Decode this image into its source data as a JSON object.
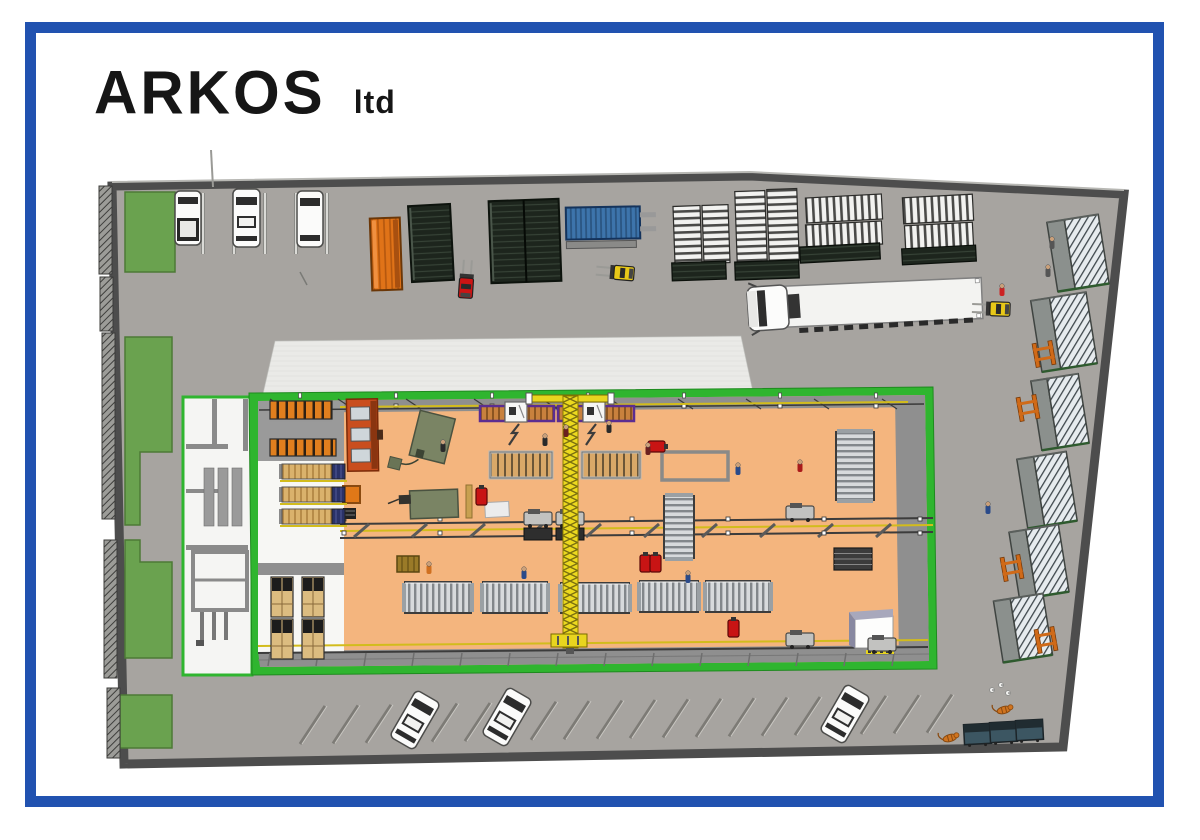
{
  "title": {
    "company": "ARKOS",
    "suffix": "ltd"
  },
  "palette": {
    "frame_blue": "#2152b0",
    "ground": "#a7a4a0",
    "wall": "#4d4d4d",
    "grass": "#6aa24f",
    "building_green": "#2fb52f",
    "floor_orange": "#f4b57e",
    "canopy": "#eaeae7",
    "container_orange": "#e07318",
    "container_dark": "#1d251d",
    "container_blue": "#3d74ab",
    "crane_yellow": "#e8d51f",
    "annex_white": "#f5f5f3"
  },
  "scene": {
    "grass": [
      {
        "pts": "125,192 175,192 175,272 125,272"
      },
      {
        "pts": "125,337 172,337 172,452 140,452 140,525 125,525"
      },
      {
        "pts": "125,540 140,540 140,562 172,562 172,658 125,658"
      },
      {
        "pts": "120,695 172,695 172,748 120,748"
      }
    ],
    "fence": [
      {
        "x": 99,
        "y": 186,
        "h": 88
      },
      {
        "x": 100,
        "y": 277,
        "h": 54
      },
      {
        "x": 102,
        "y": 333,
        "h": 186
      },
      {
        "x": 104,
        "y": 540,
        "h": 138
      },
      {
        "x": 107,
        "y": 688,
        "h": 70
      }
    ],
    "top_parking": {
      "dividers": [
        203,
        234,
        265,
        296,
        327
      ],
      "div_y1": 193,
      "div_y2": 254,
      "cars": [
        {
          "x": 175,
          "y": 191,
          "w": 26,
          "h": 54,
          "kind": "pickup"
        },
        {
          "x": 233,
          "y": 189,
          "w": 27,
          "h": 58,
          "kind": "sedan"
        },
        {
          "x": 297,
          "y": 191,
          "w": 26,
          "h": 56,
          "kind": "suv"
        }
      ]
    },
    "containers": [
      {
        "kind": "orange",
        "x": 371,
        "y": 218,
        "w": 30,
        "h": 72,
        "r": -2
      },
      {
        "kind": "dark",
        "x": 410,
        "y": 205,
        "w": 42,
        "h": 76,
        "r": -3
      },
      {
        "kind": "dark",
        "x": 490,
        "y": 200,
        "w": 70,
        "h": 82,
        "r": -2
      },
      {
        "kind": "blue",
        "x": 566,
        "y": 207,
        "w": 74,
        "h": 32,
        "r": -1
      }
    ],
    "stacks": [
      {
        "x": 674,
        "y": 206,
        "w": 27,
        "h": 58,
        "dir": "h",
        "r": -2
      },
      {
        "x": 703,
        "y": 205,
        "w": 26,
        "h": 58,
        "dir": "h",
        "r": -2
      },
      {
        "x": 736,
        "y": 191,
        "w": 30,
        "h": 72,
        "dir": "h",
        "r": -2
      },
      {
        "x": 768,
        "y": 189,
        "w": 30,
        "h": 72,
        "dir": "h",
        "r": -2
      },
      {
        "x": 806,
        "y": 196,
        "w": 76,
        "h": 25,
        "dir": "v",
        "r": -3
      },
      {
        "x": 806,
        "y": 223,
        "w": 76,
        "h": 23,
        "dir": "v",
        "r": -3
      },
      {
        "x": 903,
        "y": 196,
        "w": 70,
        "h": 26,
        "dir": "v",
        "r": -3
      },
      {
        "x": 905,
        "y": 224,
        "w": 68,
        "h": 24,
        "dir": "v",
        "r": -3
      }
    ],
    "dark_stacks": [
      {
        "x": 672,
        "y": 262,
        "w": 54,
        "h": 18,
        "r": -2
      },
      {
        "x": 735,
        "y": 261,
        "w": 64,
        "h": 18,
        "r": -2
      },
      {
        "x": 800,
        "y": 245,
        "w": 80,
        "h": 16,
        "r": -3
      },
      {
        "x": 902,
        "y": 247,
        "w": 74,
        "h": 16,
        "r": -3
      }
    ],
    "forklifts": [
      {
        "x": 459,
        "y": 276,
        "c": "#cc1414",
        "r": 4
      },
      {
        "x": 616,
        "y": 262,
        "c": "#e8c818",
        "r": -85
      },
      {
        "x": 992,
        "y": 298,
        "c": "#e8c818",
        "r": -88
      }
    ],
    "sheds": [
      {
        "x": 1052,
        "y": 218,
        "w": 52,
        "h": 70,
        "r": -9
      },
      {
        "x": 1036,
        "y": 296,
        "w": 56,
        "h": 72,
        "r": -9
      },
      {
        "x": 1036,
        "y": 377,
        "w": 48,
        "h": 70,
        "r": -9
      },
      {
        "x": 1022,
        "y": 455,
        "w": 50,
        "h": 70,
        "r": -9
      },
      {
        "x": 1014,
        "y": 528,
        "w": 50,
        "h": 68,
        "r": -9
      },
      {
        "x": 998,
        "y": 597,
        "w": 50,
        "h": 62,
        "r": -9
      }
    ],
    "trestles": [
      {
        "x": 1034,
        "y": 342
      },
      {
        "x": 1018,
        "y": 396
      },
      {
        "x": 1002,
        "y": 556
      },
      {
        "x": 1036,
        "y": 628
      }
    ],
    "bottom_parking": {
      "x0": 300,
      "step": 33,
      "count": 20,
      "y_base": 744,
      "slope": -0.018,
      "cars": [
        {
          "x": 415,
          "y": 720,
          "r": 30
        },
        {
          "x": 507,
          "y": 717,
          "r": 30
        },
        {
          "x": 845,
          "y": 714,
          "r": 30
        }
      ]
    },
    "dumpsters": [
      {
        "x": 964,
        "y": 724
      },
      {
        "x": 990,
        "y": 722
      },
      {
        "x": 1016,
        "y": 720
      }
    ],
    "cats": [
      {
        "x": 950,
        "y": 738
      },
      {
        "x": 1004,
        "y": 710
      }
    ],
    "pigeons": [
      {
        "x": 992,
        "y": 690
      },
      {
        "x": 1001,
        "y": 685
      },
      {
        "x": 1008,
        "y": 693
      }
    ],
    "workers": [
      {
        "x": 566,
        "y": 428,
        "c": "#6b1f1f"
      },
      {
        "x": 609,
        "y": 424,
        "c": "#2a2a2a"
      },
      {
        "x": 648,
        "y": 446,
        "c": "#6b1f1f"
      },
      {
        "x": 545,
        "y": 437,
        "c": "#2a2a2a"
      },
      {
        "x": 524,
        "y": 570,
        "c": "#2a4a8a"
      },
      {
        "x": 688,
        "y": 574,
        "c": "#2a4a8a"
      },
      {
        "x": 738,
        "y": 466,
        "c": "#2a4a8a"
      },
      {
        "x": 800,
        "y": 463,
        "c": "#aa1a1a"
      },
      {
        "x": 1002,
        "y": 287,
        "c": "#cc2222"
      },
      {
        "x": 988,
        "y": 505,
        "c": "#2a4a8a"
      },
      {
        "x": 429,
        "y": 565,
        "c": "#d07020"
      },
      {
        "x": 443,
        "y": 443,
        "c": "#2a2a2a"
      },
      {
        "x": 1048,
        "y": 268,
        "c": "#555555"
      },
      {
        "x": 1052,
        "y": 240,
        "c": "#555555"
      }
    ],
    "radiator_racks": [
      {
        "x": 405,
        "y": 582,
        "w": 66,
        "h": 31
      },
      {
        "x": 483,
        "y": 582,
        "w": 64,
        "h": 31
      },
      {
        "x": 561,
        "y": 583,
        "w": 68,
        "h": 30
      },
      {
        "x": 640,
        "y": 581,
        "w": 58,
        "h": 31
      },
      {
        "x": 706,
        "y": 581,
        "w": 64,
        "h": 31
      }
    ],
    "roller_racks_v": [
      {
        "x": 836,
        "y": 432,
        "w": 38,
        "h": 68
      },
      {
        "x": 664,
        "y": 496,
        "w": 30,
        "h": 62
      }
    ],
    "dark_grid_rack": {
      "x": 834,
      "y": 548,
      "w": 38,
      "h": 22
    },
    "pallet_rows": [
      {
        "y": 464
      },
      {
        "y": 487
      },
      {
        "y": 509
      }
    ],
    "orange_racks": [
      {
        "x": 270,
        "y": 401,
        "w": 62,
        "h": 18
      },
      {
        "x": 270,
        "y": 439,
        "w": 66,
        "h": 17
      }
    ],
    "stacks_bl": [
      {
        "x": 271,
        "y": 577
      },
      {
        "x": 302,
        "y": 577
      },
      {
        "x": 271,
        "y": 619
      },
      {
        "x": 302,
        "y": 619
      }
    ],
    "benches": [
      {
        "x": 480,
        "y": 406,
        "w": 74
      },
      {
        "x": 558,
        "y": 406,
        "w": 76
      }
    ],
    "wood_tables": [
      {
        "x": 490,
        "y": 452,
        "w": 62,
        "h": 26
      },
      {
        "x": 582,
        "y": 452,
        "w": 58,
        "h": 26
      }
    ],
    "outline_tables": [
      {
        "x": 662,
        "y": 452,
        "w": 66,
        "h": 28
      }
    ],
    "white_machines": [
      {
        "x": 505,
        "y": 402
      },
      {
        "x": 583,
        "y": 402
      }
    ],
    "bolts": [
      {
        "x": 513,
        "y": 424
      },
      {
        "x": 590,
        "y": 424
      }
    ],
    "carts": [
      {
        "x": 786,
        "y": 506
      },
      {
        "x": 786,
        "y": 633
      },
      {
        "x": 524,
        "y": 512,
        "double": true
      },
      {
        "x": 556,
        "y": 512,
        "double": true
      },
      {
        "x": 868,
        "y": 638
      }
    ],
    "canisters": [
      {
        "x": 476,
        "y": 488,
        "r": 0
      },
      {
        "x": 728,
        "y": 620,
        "r": 0
      },
      {
        "x": 640,
        "y": 555,
        "r": 0
      },
      {
        "x": 650,
        "y": 555,
        "r": 0
      },
      {
        "x": 652,
        "y": 438,
        "r": 90
      }
    ]
  }
}
